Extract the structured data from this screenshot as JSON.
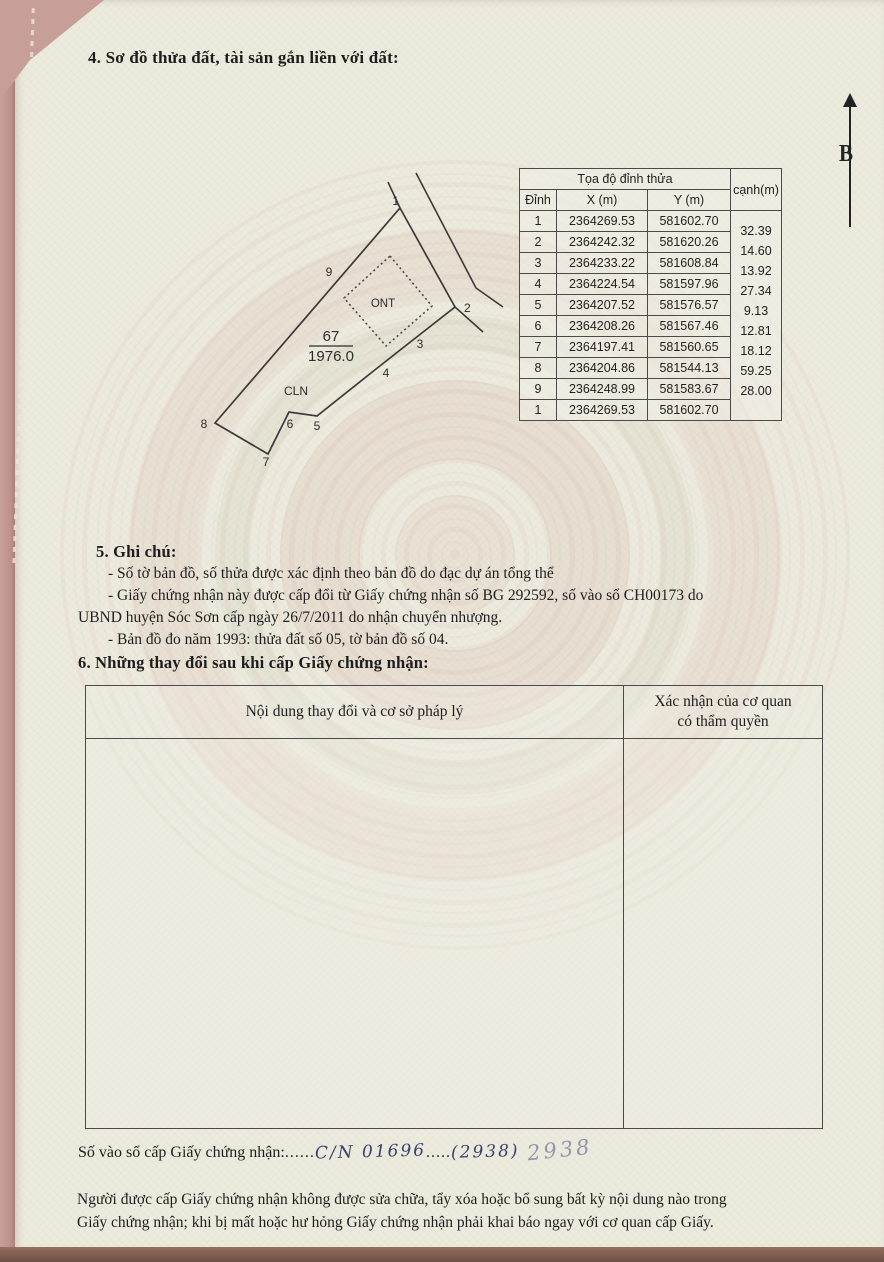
{
  "page": {
    "section4_title": "4. Sơ đồ thửa đất, tài sản gắn liền với đất:",
    "north_label": "B"
  },
  "diagram": {
    "parcel_number": "67",
    "parcel_area": "1976.0",
    "zone_ont": "ONT",
    "zone_cln": "CLN",
    "v1": "1",
    "v2": "2",
    "v3": "3",
    "v4": "4",
    "v5": "5",
    "v6": "6",
    "v7": "7",
    "v8": "8",
    "v9": "9"
  },
  "coord_table": {
    "title": "Tọa độ đỉnh thửa",
    "col_dinh": "Đỉnh",
    "col_x": "X (m)",
    "col_y": "Y (m)",
    "col_canh": "cạnh(m)",
    "rows": [
      {
        "dinh": "1",
        "x": "2364269.53",
        "y": "581602.70"
      },
      {
        "dinh": "2",
        "x": "2364242.32",
        "y": "581620.26"
      },
      {
        "dinh": "3",
        "x": "2364233.22",
        "y": "581608.84"
      },
      {
        "dinh": "4",
        "x": "2364224.54",
        "y": "581597.96"
      },
      {
        "dinh": "5",
        "x": "2364207.52",
        "y": "581576.57"
      },
      {
        "dinh": "6",
        "x": "2364208.26",
        "y": "581567.46"
      },
      {
        "dinh": "7",
        "x": "2364197.41",
        "y": "581560.65"
      },
      {
        "dinh": "8",
        "x": "2364204.86",
        "y": "581544.13"
      },
      {
        "dinh": "9",
        "x": "2364248.99",
        "y": "581583.67"
      },
      {
        "dinh": "1",
        "x": "2364269.53",
        "y": "581602.70"
      }
    ],
    "canh_values": [
      "32.39",
      "14.60",
      "13.92",
      "27.34",
      "9.13",
      "12.81",
      "18.12",
      "59.25",
      "28.00"
    ]
  },
  "section5": {
    "title": "5. Ghi chú:",
    "line1": "- Số tờ bản đồ, số thửa được xác định theo bản đồ do đạc dự án tổng thể",
    "line2": "- Giấy chứng nhận này được cấp đổi từ Giấy chứng nhận số BG 292592, số vào sổ CH00173 do",
    "line3": "UBND huyện Sóc Sơn cấp ngày 26/7/2011 do nhận chuyển nhượng.",
    "line4": "- Bản đồ đo năm 1993: thửa đất số 05, tờ bản đồ số 04."
  },
  "section6": {
    "title": "6. Những thay đổi sau khi cấp Giấy chứng nhận:",
    "col1_header": "Nội dung thay đổi và cơ sở pháp lý",
    "col2_header_line1": "Xác nhận của cơ quan",
    "col2_header_line2": "có thẩm quyền"
  },
  "footer": {
    "so_vao_so_label": "Số vào sổ cấp Giấy chứng nhận:",
    "dots1": "......",
    "handwritten_value": "C/N 01696",
    "dots2": ".....",
    "handwritten_paren": "(2938)",
    "pencil_note": "2938",
    "notice_line1": "Người được cấp Giấy chứng nhận không được sửa chữa, tẩy xóa hoặc bổ sung bất kỳ nội dung nào trong",
    "notice_line2": "Giấy chứng nhận; khi bị mất hoặc hư hỏng Giấy chứng nhận phải khai báo ngay với cơ quan cấp Giấy."
  }
}
